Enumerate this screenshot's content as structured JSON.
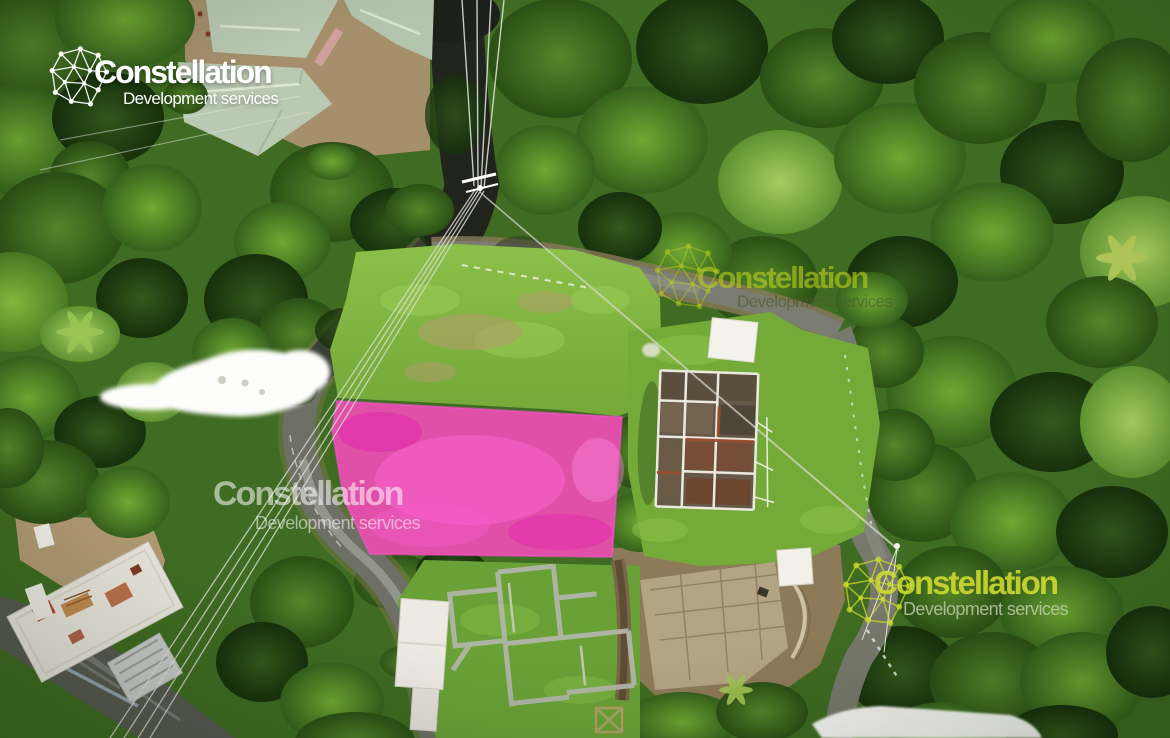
{
  "watermarks": [
    {
      "id": "top-left",
      "brand": "Constellation",
      "tagline": "Development services",
      "style": "white",
      "logo_icon": "constellation-network"
    },
    {
      "id": "center",
      "brand": "Constellation",
      "tagline": "Development services",
      "style": "lime-faint",
      "logo_icon": "constellation-network"
    },
    {
      "id": "middle-left",
      "brand": "Constellation",
      "tagline": "Development services",
      "style": "white-faint",
      "logo_icon": null
    },
    {
      "id": "bottom-right",
      "brand": "Constellation",
      "tagline": "Development services",
      "style": "lime",
      "logo_icon": "constellation-network"
    }
  ],
  "colors": {
    "highlight_parcel_pink": "#f41ec9",
    "watermark_white": "#ffffff",
    "watermark_lime": "#d0de32",
    "roof_sage_green": "#b9c9b2"
  },
  "scene_notes": {
    "subject": "aerial drone photo of hillside lots",
    "highlighted_parcel": "pink overlay quadrilateral beside road"
  }
}
